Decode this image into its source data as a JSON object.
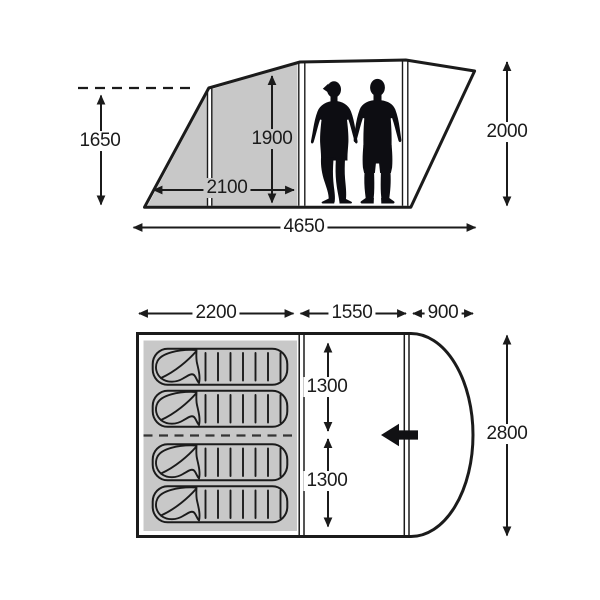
{
  "diagram": {
    "type": "tent dimensions diagram",
    "views": {
      "side_view": {
        "label": "side elevation",
        "dimensions": {
          "front_height": "1650",
          "inner_height": "1900",
          "front_section_depth": "2100",
          "overall_length": "4650",
          "rear_height": "2000"
        },
        "occupants": 2
      },
      "floor_plan": {
        "label": "floor plan",
        "dimensions": {
          "bedroom_section_length": "2200",
          "living_section_length": "1550",
          "front_section_length": "900",
          "bedroom_width_upper": "1300",
          "bedroom_width_lower": "1300",
          "overall_width": "2800"
        },
        "sleeping_bag_count": 4,
        "entrance_arrow_direction": "left"
      }
    },
    "icons": {
      "woman": "woman-silhouette",
      "man": "man-silhouette",
      "sleeping_bag": "sleeping-bag-top-view-icon",
      "entrance": "entrance-left-arrow-icon"
    },
    "colors": {
      "canvas_grey": "#c8c8c8",
      "line": "#1b1b1b",
      "background": "#ffffff",
      "silhouette": "#0d0d12"
    }
  }
}
